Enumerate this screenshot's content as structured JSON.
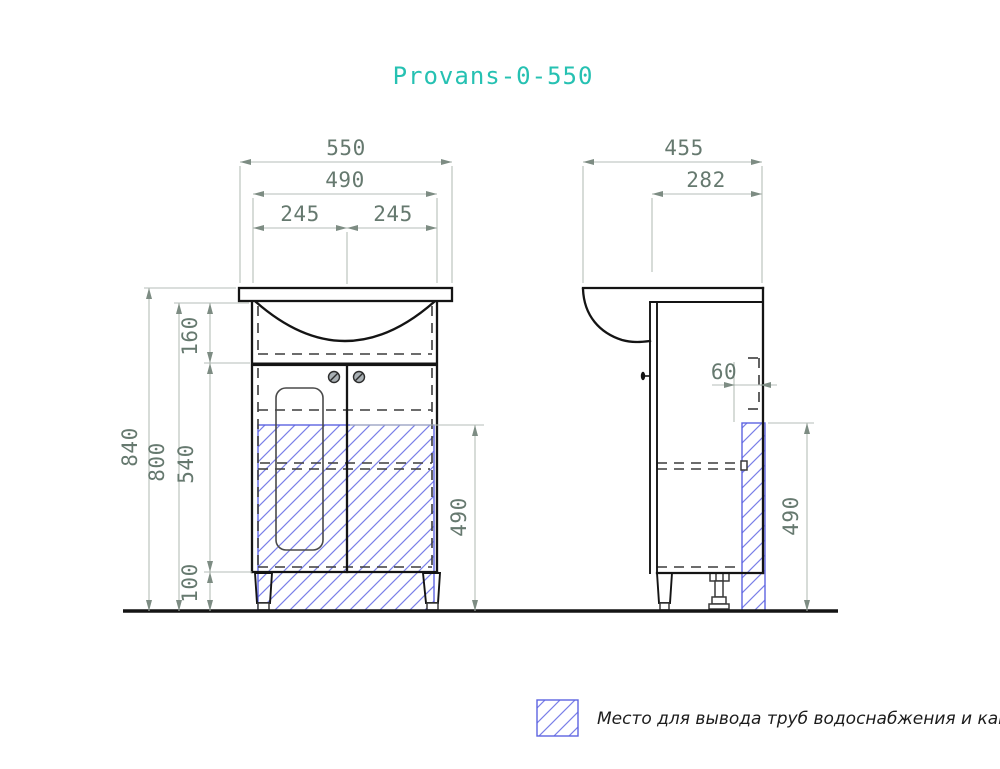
{
  "title": "Provans-0-550",
  "colors": {
    "title": "#26c1b2",
    "dim_text": "#66796f",
    "dim_line": "#b6beb8",
    "hatch_blue": "#7a7fe8",
    "outline": "#141414"
  },
  "front_view": {
    "dim_width_total": "550",
    "dim_width_inner": "490",
    "dim_width_left_half": "245",
    "dim_width_right_half": "245",
    "dim_height_total": "840",
    "dim_height_cabinet": "800",
    "dim_basin_section": "160",
    "dim_door_section": "540",
    "dim_legs": "100",
    "dim_pipe_zone_height": "490"
  },
  "side_view": {
    "dim_depth_total": "455",
    "dim_depth_inner": "282",
    "dim_pipe_offset": "60",
    "dim_pipe_zone_height": "490"
  },
  "legend": {
    "label": "Место для вывода труб водоснабжения и канализации"
  }
}
